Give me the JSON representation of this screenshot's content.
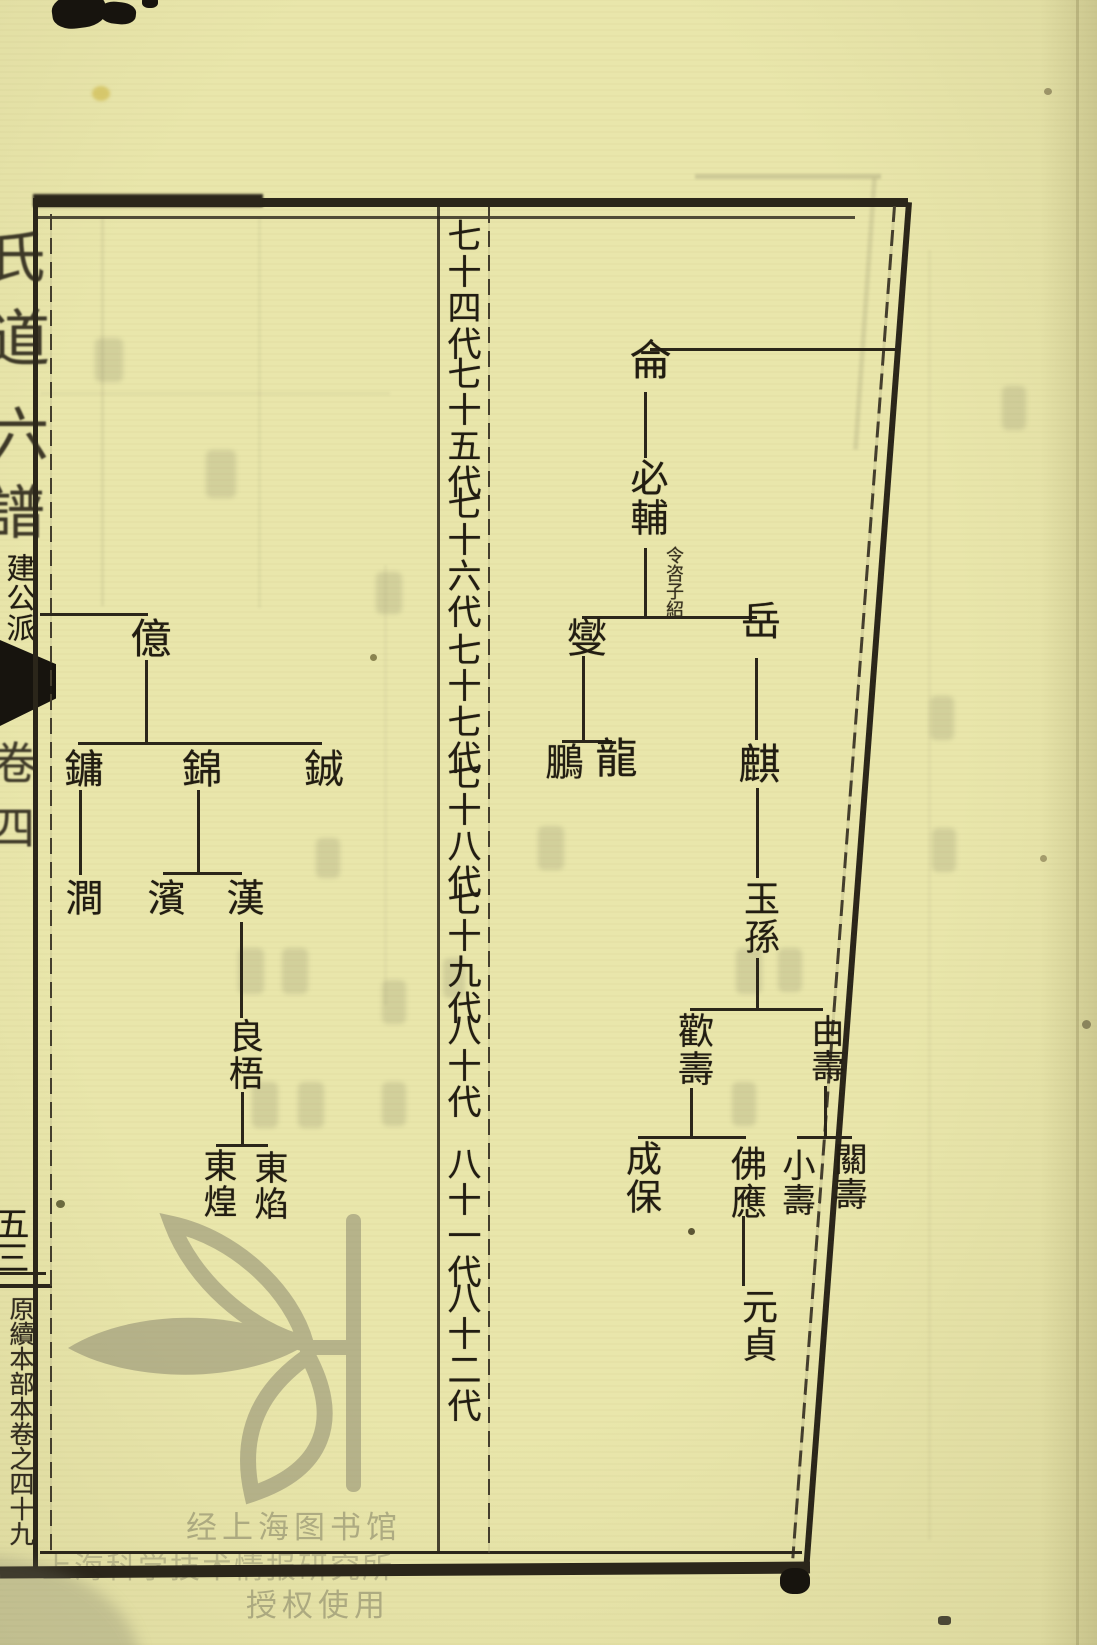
{
  "page": {
    "kind": "Scanned woodblock-printed Chinese genealogy chart page (世系圖)",
    "paper_color": "#e9e6ab",
    "ink_color": "#2b261a",
    "watermark_color": "#aba88d"
  },
  "left_margin": {
    "title_fragments": [
      "氏",
      "道",
      "六",
      "譜"
    ],
    "branch_label": "建公派",
    "volume_fragments": [
      "卷",
      "四"
    ],
    "page_number": "五三",
    "colophon": "原續本部本卷之四十九"
  },
  "generation_column": {
    "labels": [
      "七十四代",
      "七十五代",
      "七十六代",
      "七十七代",
      "七十八代",
      "七十九代",
      "八十代",
      "八十一代",
      "八十二代"
    ]
  },
  "right_tree": {
    "nodes": [
      {
        "label": "侖"
      },
      {
        "label": "必輔"
      },
      {
        "label": "燮"
      },
      {
        "label": "岳"
      },
      {
        "label": "鵬"
      },
      {
        "label": "龍"
      },
      {
        "label": "麒"
      },
      {
        "label": "玉孫"
      },
      {
        "label": "歡壽"
      },
      {
        "label": "由壽"
      },
      {
        "label": "成保"
      },
      {
        "label": "佛應"
      },
      {
        "label": "小壽"
      },
      {
        "label": "關壽"
      },
      {
        "label": "元貞"
      }
    ],
    "note": "令咨子紹",
    "structure": "侖→必輔; 必輔→(燮,岳); 燮→(鵬,龍); 岳→麒; 麒→玉孫; 玉孫→(歡壽,由壽); 歡壽→(成保,佛應); 由壽→(小壽,關壽); 佛應→元貞"
  },
  "left_tree": {
    "nodes": [
      {
        "label": "億"
      },
      {
        "label": "鏞"
      },
      {
        "label": "錦"
      },
      {
        "label": "鋮"
      },
      {
        "label": "澗"
      },
      {
        "label": "濱"
      },
      {
        "label": "漢"
      },
      {
        "label": "良梧"
      },
      {
        "label": "東煌"
      },
      {
        "label": "東焰"
      }
    ],
    "structure": "(off-page parent)→億; 億→(鏞,錦,鋮); 鏞→澗; 錦→(濱,漢); 漢→良梧; 良梧→(東煌,東焰)"
  },
  "watermark": {
    "logo": "leaf-branch library logo",
    "lines": [
      "经上海图书馆",
      "上海科学技术情报研究所",
      "授权使用"
    ]
  }
}
